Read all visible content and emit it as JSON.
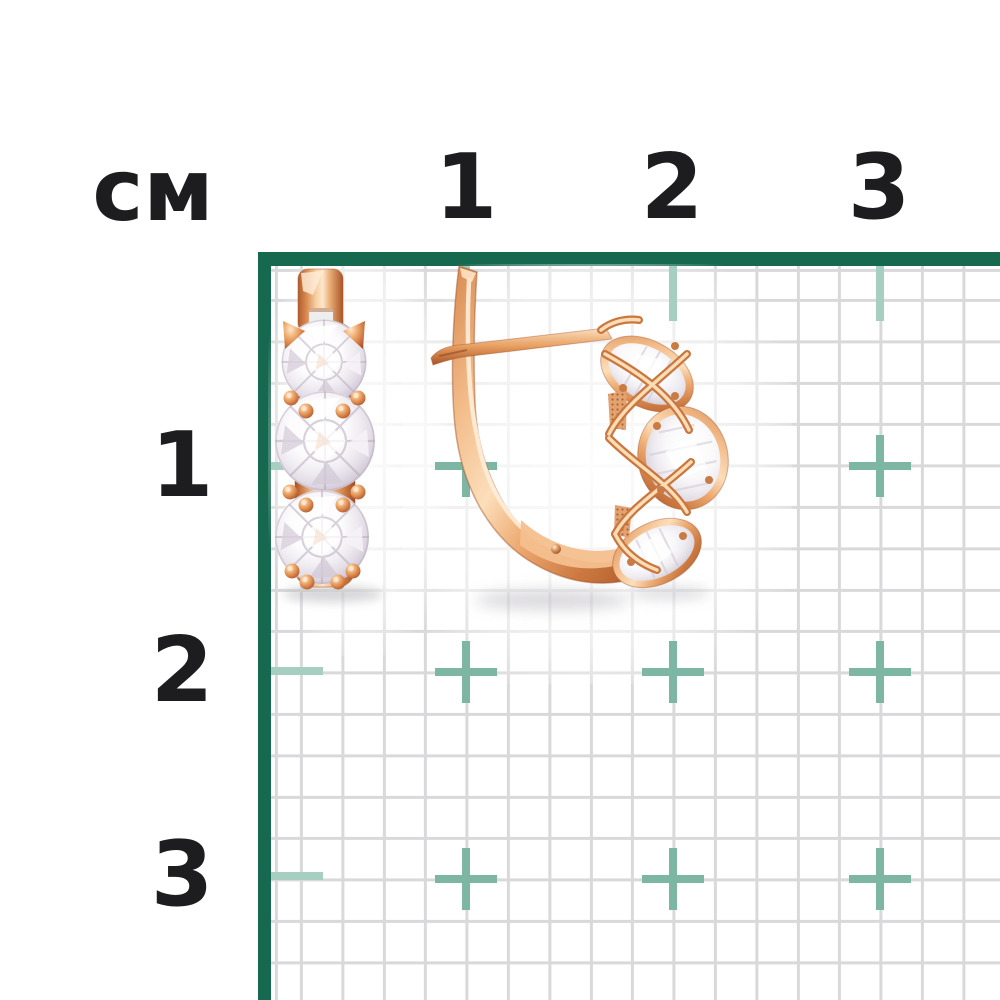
{
  "ruler": {
    "unit_label": "см",
    "top_labels": [
      "1",
      "2",
      "3"
    ],
    "left_labels": [
      "1",
      "2",
      "3"
    ]
  },
  "style": {
    "border_green": "#16694e",
    "tick_teal": "#a7cfc1",
    "cross_teal": "#7db6a2",
    "grid_line_gray": "#d9d9db",
    "label_color": "#1d1d1f",
    "gold_highlight": "#fde3c4",
    "gold_base": "#e79e60",
    "gold_deep": "#a85426",
    "stone_color": "#ffffff"
  },
  "icons": {
    "cross_mark": "cm-intersection-cross",
    "tick_mark": "cm-edge-tick"
  }
}
